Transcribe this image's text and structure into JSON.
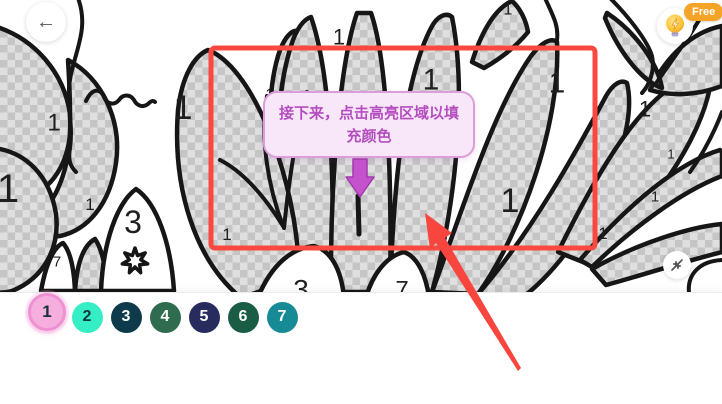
{
  "header": {
    "back_button": {
      "icon": "left-arrow-icon",
      "glyph": "←"
    },
    "hint_button": {
      "icon": "lightbulb-bolt-icon",
      "badge": "Free"
    }
  },
  "tutorial": {
    "tooltip_text": "接下来，点击高亮区域以填充颜色",
    "tooltip_line1": "接下来，点击高亮区域以填",
    "tooltip_line2": "充颜色",
    "highlight_color": "#f8483f",
    "pointer_color": "#f8453e",
    "down_arrow_color": "#c352cc"
  },
  "canvas": {
    "line_color": "#161616",
    "checker_light": "#dfdfdf",
    "checker_dark": "#c5c5c5",
    "region_numbers": [
      {
        "label": "1",
        "x": 183,
        "y": 107,
        "size": 34
      },
      {
        "label": "1",
        "x": 54,
        "y": 122,
        "size": 24
      },
      {
        "label": "1",
        "x": 8,
        "y": 188,
        "size": 40
      },
      {
        "label": "1",
        "x": 90,
        "y": 204,
        "size": 17
      },
      {
        "label": "1",
        "x": 339,
        "y": 37,
        "size": 22
      },
      {
        "label": "1",
        "x": 431,
        "y": 79,
        "size": 30
      },
      {
        "label": "1",
        "x": 557,
        "y": 82,
        "size": 30
      },
      {
        "label": "1",
        "x": 270,
        "y": 94,
        "size": 17
      },
      {
        "label": "1",
        "x": 510,
        "y": 200,
        "size": 34
      },
      {
        "label": "1",
        "x": 645,
        "y": 109,
        "size": 22
      },
      {
        "label": "1",
        "x": 671,
        "y": 154,
        "size": 13
      },
      {
        "label": "1",
        "x": 655,
        "y": 196,
        "size": 15
      },
      {
        "label": "1",
        "x": 603,
        "y": 233,
        "size": 17
      },
      {
        "label": "1",
        "x": 227,
        "y": 234,
        "size": 17
      },
      {
        "label": "1",
        "x": 508,
        "y": 9,
        "size": 16
      },
      {
        "label": "3",
        "x": 133,
        "y": 222,
        "size": 32
      },
      {
        "label": "7",
        "x": 57,
        "y": 261,
        "size": 15
      },
      {
        "label": "3",
        "x": 301,
        "y": 289,
        "size": 28
      },
      {
        "label": "7",
        "x": 402,
        "y": 289,
        "size": 24
      }
    ],
    "star": {
      "cx": 135,
      "cy": 261,
      "points": 7,
      "outer": 13,
      "inner": 6
    }
  },
  "controls": {
    "collapse_button": {
      "icon": "collapse-arrows-icon"
    }
  },
  "palette": {
    "selected_number": "1",
    "colors": [
      {
        "number": "1",
        "fill": "#f6aede",
        "ring": "#ee90d2",
        "text_color": "#17313c",
        "selected": true
      },
      {
        "number": "2",
        "fill": "#36eec6",
        "text_color": "#0d3540",
        "selected": false
      },
      {
        "number": "3",
        "fill": "#0d3b4c",
        "text_color": "#ffffff",
        "selected": false
      },
      {
        "number": "4",
        "fill": "#2e6b4f",
        "text_color": "#ffffff",
        "selected": false
      },
      {
        "number": "5",
        "fill": "#272b5e",
        "text_color": "#ffffff",
        "selected": false
      },
      {
        "number": "6",
        "fill": "#1a5c44",
        "text_color": "#ffffff",
        "selected": false
      },
      {
        "number": "7",
        "fill": "#168b95",
        "text_color": "#ffffff",
        "selected": false
      }
    ]
  }
}
